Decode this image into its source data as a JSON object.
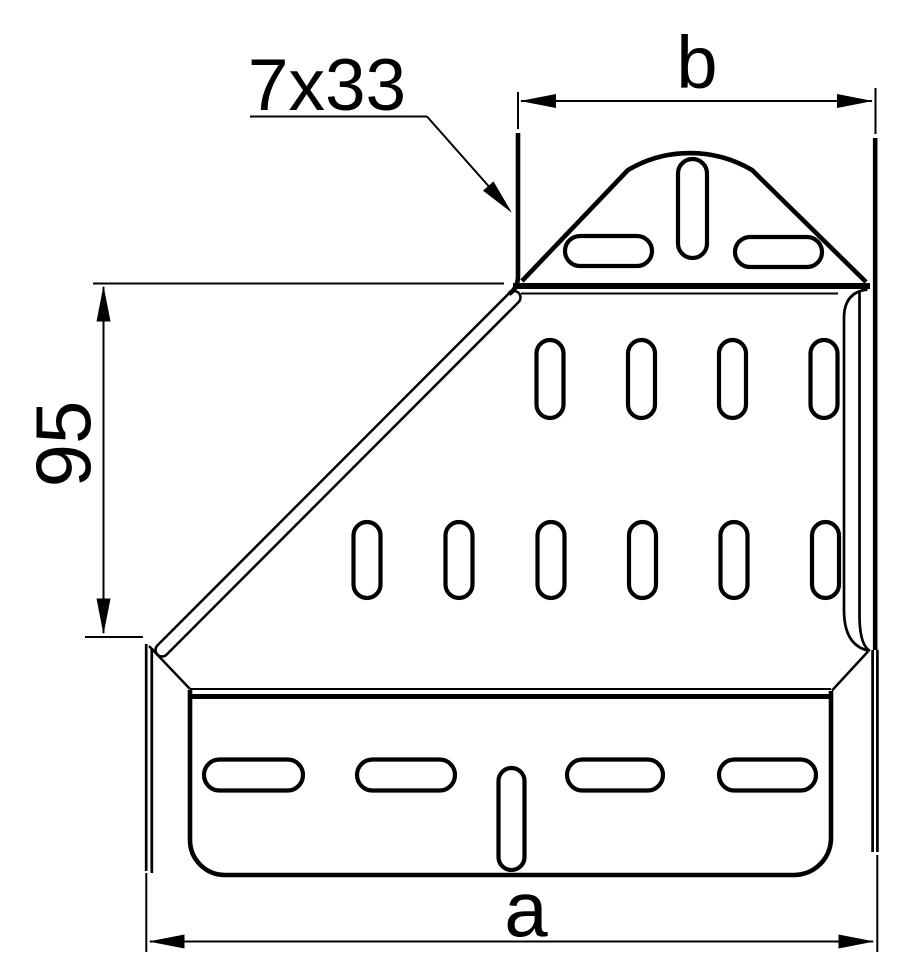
{
  "drawing": {
    "background_color": "#ffffff",
    "line_color": "#000000",
    "labels": {
      "slot_callout": "7x33",
      "top_width": "b",
      "left_height": "95",
      "bottom_width": "a"
    }
  }
}
